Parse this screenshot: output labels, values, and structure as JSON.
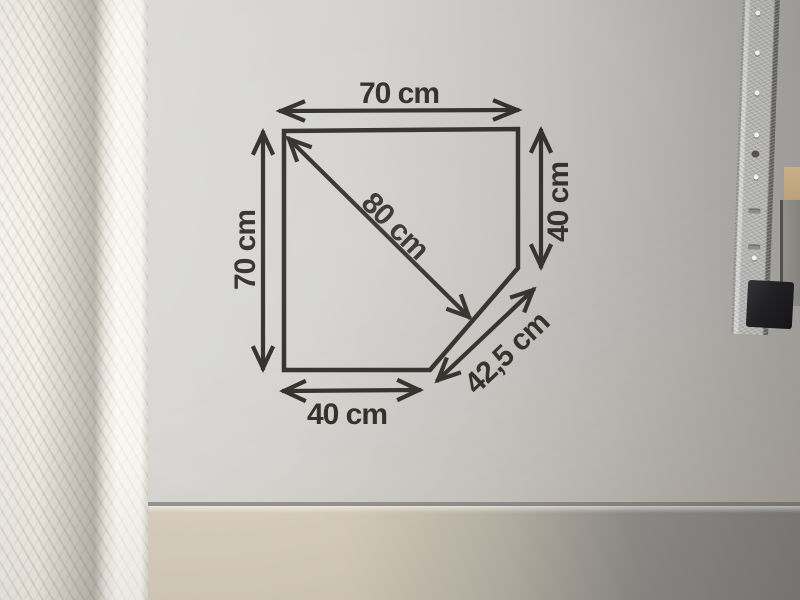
{
  "diagram": {
    "dim_top": "70 cm",
    "dim_left": "70 cm",
    "dim_right": "40 cm",
    "dim_bottom": "40 cm",
    "dim_diagonal": "80 cm",
    "dim_cut": "42,5 cm",
    "colors": {
      "ink": "#2d2a26",
      "paper": "#cfcecc",
      "wallpaper": "#e9e6dc",
      "table_left": "#d2c9b8",
      "table_right": "#7f7e7c",
      "rail": "#b5b5b3",
      "rail_cap": "#212125",
      "wood_block": "#c3a87f"
    }
  }
}
